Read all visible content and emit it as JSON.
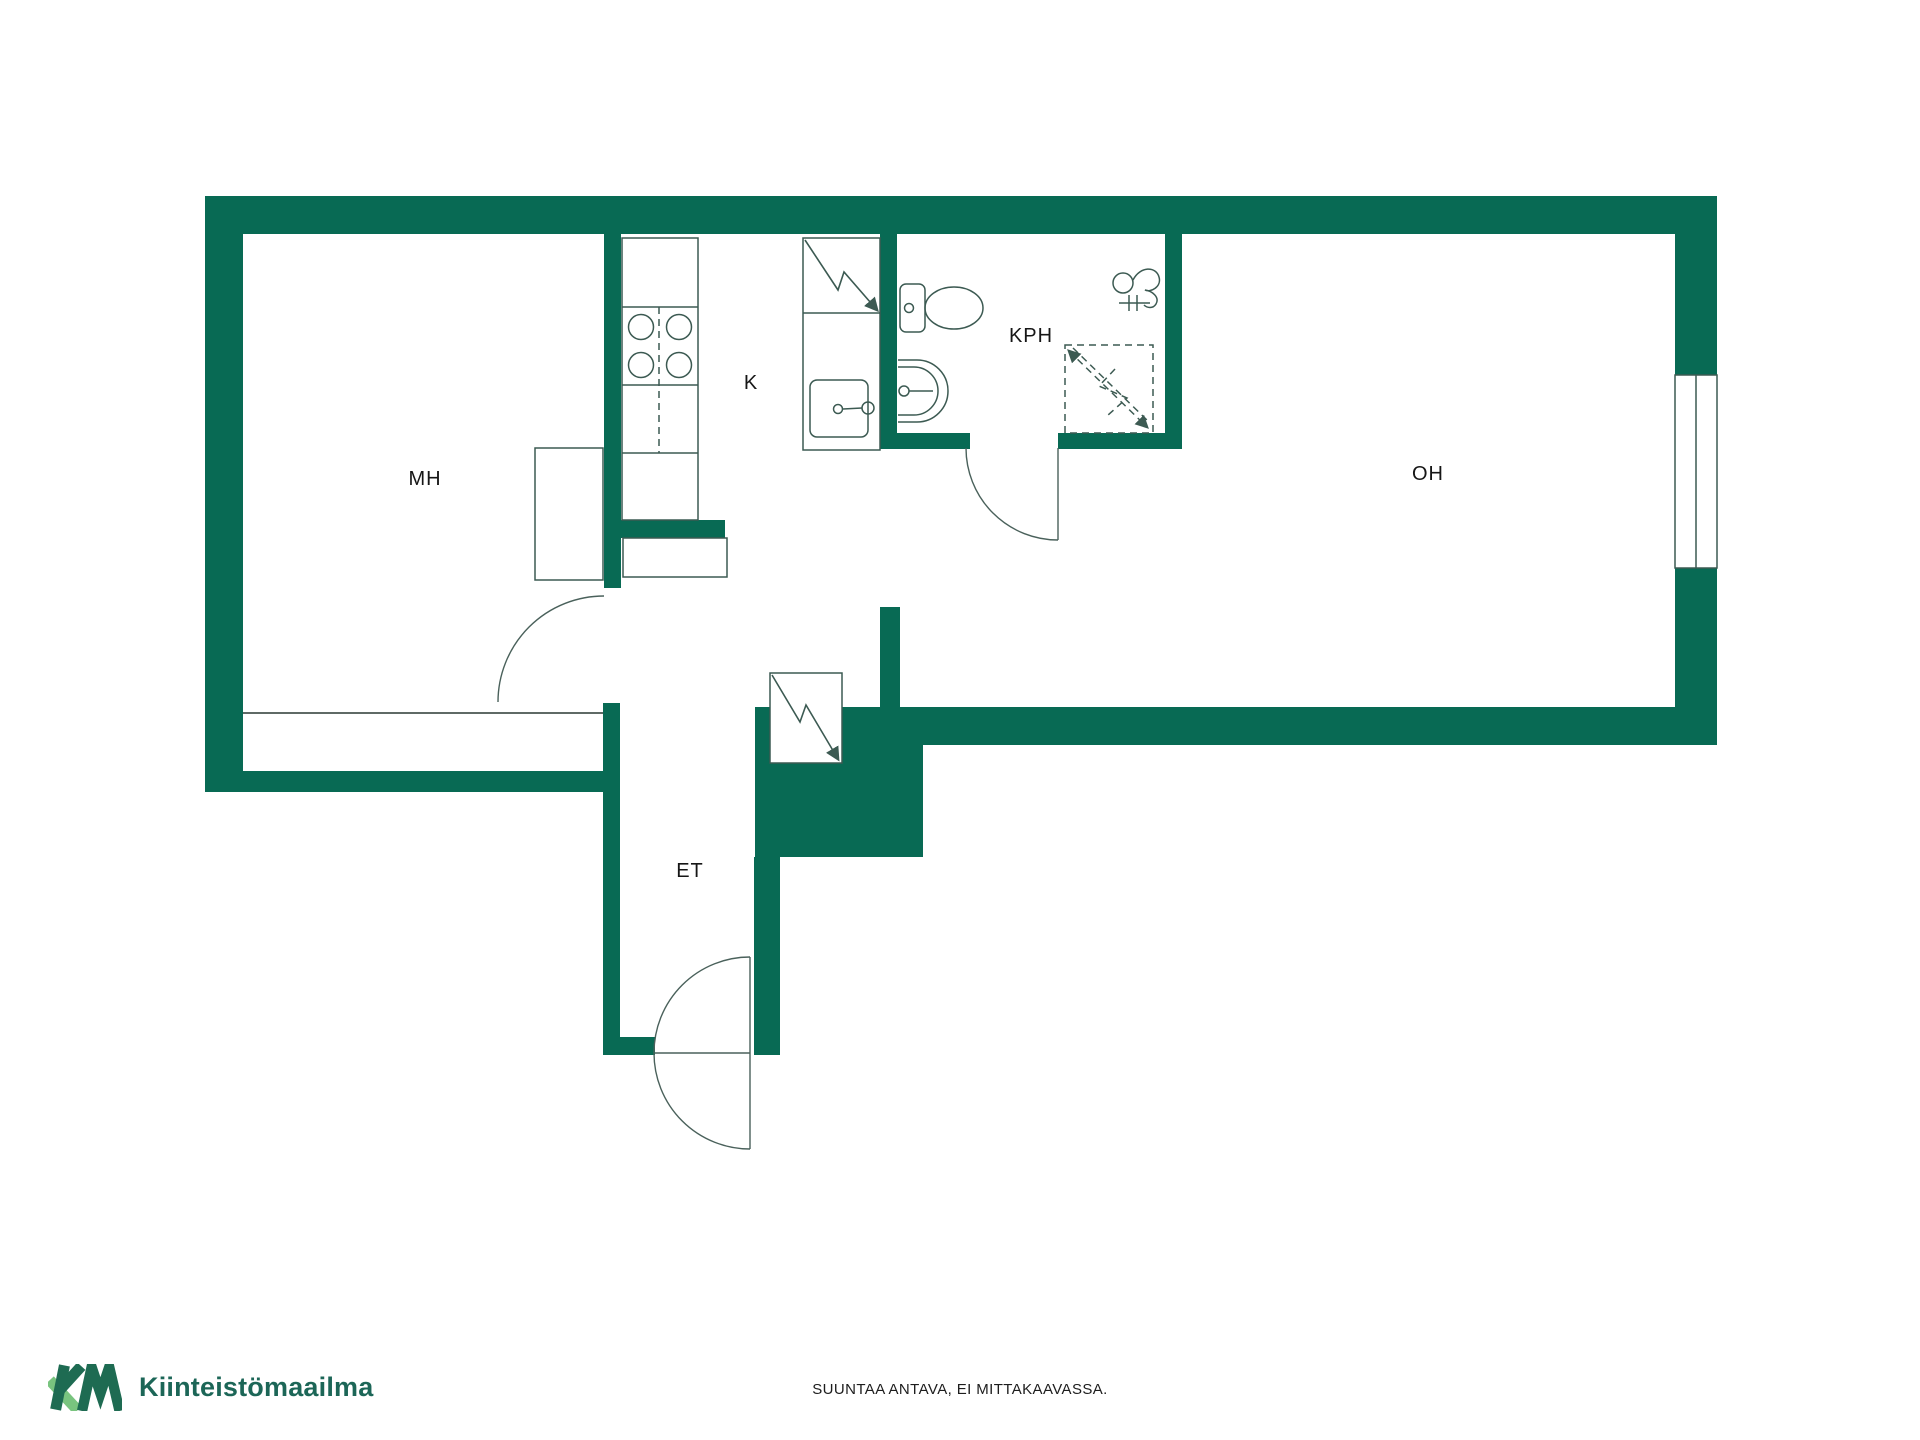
{
  "floorplan": {
    "wall_color": "#086a54",
    "line_color": "#3c5a52",
    "background": "#ffffff",
    "rooms": [
      {
        "label": "MH"
      },
      {
        "label": "K"
      },
      {
        "label": "KPH"
      },
      {
        "label": "OH"
      },
      {
        "label": "ET"
      }
    ],
    "icons": [
      "stove-icon",
      "kitchen-sink-icon",
      "electrical-panel-icon",
      "toilet-icon",
      "washbasin-icon",
      "shower-icon",
      "towel-hook-icon",
      "wardrobe",
      "window",
      "door-swing"
    ]
  },
  "footer": {
    "caption": "SUUNTAA ANTAVA, EI MITTAKAAVASSA."
  },
  "logo": {
    "text": "Kiinteistömaailma",
    "dark_color": "#1e6b52",
    "light_color": "#79c47f"
  }
}
